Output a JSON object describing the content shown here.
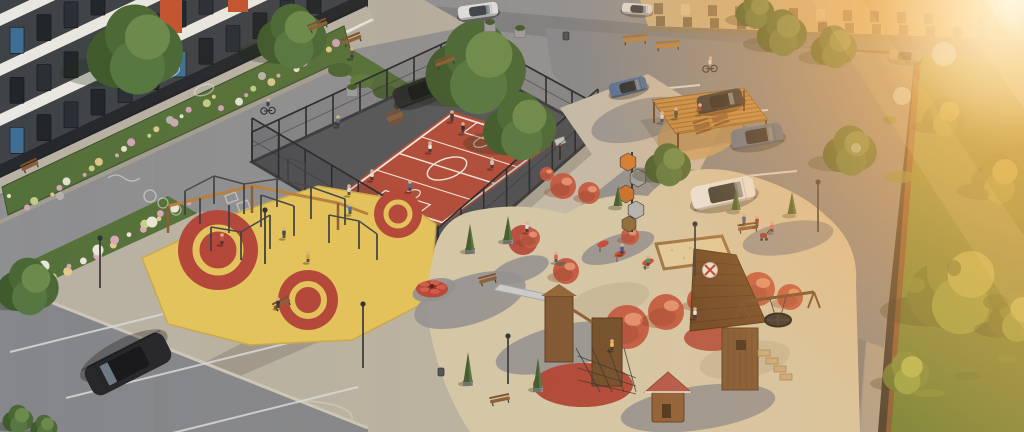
{
  "scene": {
    "type": "aerial 3D architectural rendering",
    "subject": "residential courtyard with fenced sports court, street-workout zone, children's playground, parking areas and a sunlit lawn",
    "lighting": "golden hour, strong lens sun-flare from the upper-right corner",
    "people_visible": 28,
    "vehicles_visible": 9
  },
  "colors": {
    "asphalt": "#8f9092",
    "road": "#8e8f91",
    "road_far": "#7d7f82",
    "parking_asphalt": "#85878b",
    "paver_plaza": "#b9b2a3",
    "paver_light": "#c3baaa",
    "court_red": "#ae4b3a",
    "court_line": "#ece7de",
    "court_apron": "#54565a",
    "fence": "#2f3338",
    "workout_yellow": "#e2c35c",
    "workout_red": "#b2463a",
    "playground_base": "#d3c7a9",
    "dome_red": "#c05a44",
    "wood": "#7d5633",
    "wood_light": "#b5803f",
    "roof_red": "#b0564a",
    "ramp_brown": "#6a4526",
    "building_wall": "#3f4347",
    "building_band": "#e9e7e1",
    "building_accent": "#c2552f",
    "far_building": "#c9b287",
    "hedge": "#3c4a30",
    "bed_green": "#55713a",
    "grass_sun": "#7f9a43",
    "grass_deep": "#5e7c34",
    "sun_core": "#fff3d4",
    "sun_gold": "#ffbe66",
    "car_black": "#26272a",
    "car_white": "#e7e8e9",
    "car_blue": "#5a7191",
    "car_dark": "#313438"
  },
  "areas": {
    "apartment_building": {
      "label": "apartment building",
      "facade": "dark charcoal panels with white interfloor bands and orange accent panels",
      "windows": "dark glazing with blue reflections"
    },
    "far_building": {
      "label": "neighbouring building across the street",
      "facade": "sun-washed beige with a grid of windows"
    },
    "sports_court": {
      "label": "fenced multisport court",
      "surface": "red rubber",
      "markings": "white football and basketball lines, centre circle, goal boxes",
      "fence": "dark steel mesh on posts",
      "goals": 2,
      "basketball_hoops": 2,
      "players_on_court": 7
    },
    "workout_zone": {
      "label": "street workout area",
      "surface": "yellow rubber with red target circles",
      "equipment": "steel pull-up, parallel and monkey bars with timber frame"
    },
    "playground": {
      "label": "children's playground",
      "surface": "beige rubber with grey paver swirls and red circles",
      "features": [
        "red climbing domes",
        "timber play towers",
        "shingled climbing ramp with round badge",
        "metal slide",
        "sandbox with timber edge",
        "nest swing",
        "red spring riders",
        "red merry-go-round carousel",
        "small playhouse with red roof",
        "hexagon climbing sculpture",
        "timber shade pergola with picnic tables"
      ]
    },
    "parking_left": {
      "label": "lower-left parking bays",
      "cars": [
        {
          "type": "SUV",
          "color": "black"
        }
      ]
    },
    "parking_right": {
      "label": "right parking lot",
      "cars": [
        {
          "type": "compact",
          "color": "blue"
        },
        {
          "type": "hatchback",
          "color": "dark grey"
        },
        {
          "type": "SUV",
          "color": "blue"
        },
        {
          "type": "SUV",
          "color": "white"
        }
      ]
    },
    "street_top": {
      "label": "access street",
      "cars": [
        {
          "type": "sedan",
          "color": "black"
        },
        {
          "type": "pickup",
          "color": "white"
        },
        {
          "type": "car",
          "color": "white"
        },
        {
          "type": "car",
          "color": "grey"
        }
      ]
    },
    "lawn": {
      "label": "sunlit meadow behind the stylobate parapet",
      "vegetation": "tall grass and deciduous trees"
    },
    "parapet": {
      "label": "stylobate parapet wall with cobble maintenance path"
    }
  },
  "landscape": {
    "flower_beds": "green perennial beds with pink and white flowers and boulders along the building",
    "trees": "large deciduous trees plus conical thujas in planters",
    "benches": 12,
    "lamps": 6,
    "extras": [
      "chalk drawings on asphalt",
      "cyclists",
      "woman with stroller",
      "dog"
    ]
  }
}
